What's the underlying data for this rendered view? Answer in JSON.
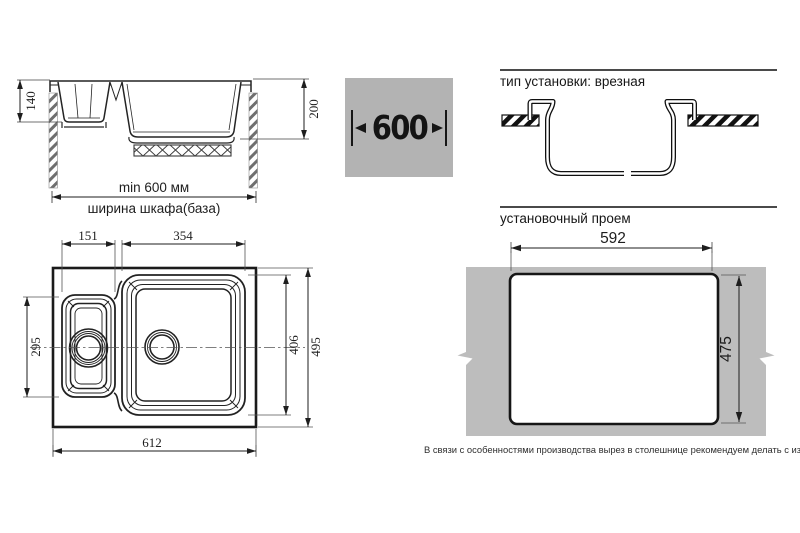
{
  "side_view": {
    "small_bowl_depth": "140",
    "large_bowl_depth": "200",
    "min_cabinet_width": "min 600 мм",
    "cabinet_label": "ширина шкафа(база)"
  },
  "cabinet_badge": {
    "value": "600"
  },
  "install_type": {
    "title": "тип установки: врезная"
  },
  "install_opening": {
    "title": "установочный проем",
    "cutout_width": "592",
    "cutout_height": "475",
    "note": "В связи с особенностями производства вырез в столешнице рекомендуем делать с изделия."
  },
  "top_view": {
    "small_bowl_width": "151",
    "large_bowl_width": "354",
    "small_bowl_length": "295",
    "large_bowl_length": "406",
    "overall_length": "495",
    "overall_width": "612"
  },
  "colors": {
    "line": "#1e1e1e",
    "badge_bg": "#b3b3b3",
    "countertop_gray": "#bdbdbd"
  }
}
